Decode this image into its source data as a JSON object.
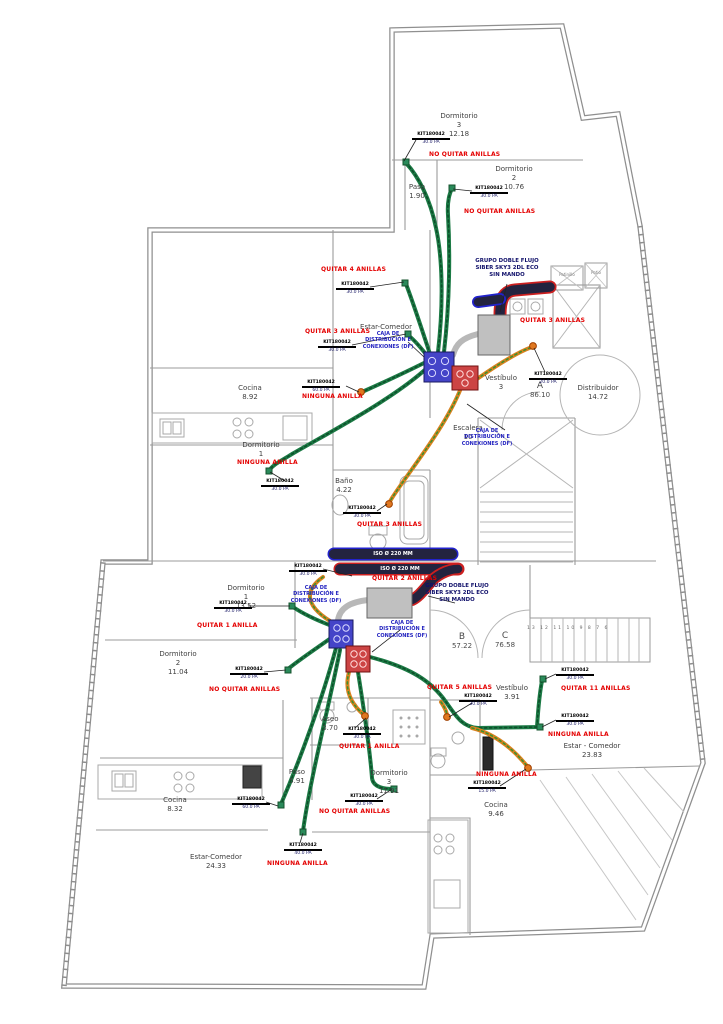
{
  "plan": {
    "apartments": [
      {
        "letter": "A",
        "area": "86.10"
      },
      {
        "letter": "B",
        "area": "57.22"
      },
      {
        "letter": "C",
        "area": "76.58"
      }
    ],
    "rooms": [
      {
        "name": "Dormitorio",
        "num": "3",
        "area": "12.18"
      },
      {
        "name": "Dormitorio",
        "num": "2",
        "area": "10.76"
      },
      {
        "name": "Paso",
        "num": "",
        "area": "1.90"
      },
      {
        "name": "Estar-Comedor",
        "num": "",
        "area": ""
      },
      {
        "name": "Cocina",
        "num": "",
        "area": "8.92"
      },
      {
        "name": "Dormitorio",
        "num": "1",
        "area": ""
      },
      {
        "name": "Baño",
        "num": "",
        "area": "4.22"
      },
      {
        "name": "Vestíbulo",
        "num": "3",
        "area": ""
      },
      {
        "name": "Distribuidor",
        "num": "",
        "area": "14.72"
      },
      {
        "name": "Escalera",
        "num": "10",
        "area": ""
      },
      {
        "name": "Dormitorio",
        "num": "1",
        "area": "13.52"
      },
      {
        "name": "Dormitorio",
        "num": "2",
        "area": "11.04"
      },
      {
        "name": "Cocina",
        "num": "",
        "area": "8.32"
      },
      {
        "name": "Estar-Comedor",
        "num": "",
        "area": "24.33"
      },
      {
        "name": "Dormitorio",
        "num": "3",
        "area": "11.91"
      },
      {
        "name": "Aseo",
        "num": "",
        "area": "3.70"
      },
      {
        "name": "Paso",
        "num": "",
        "area": "5.91"
      },
      {
        "name": "Vestíbulo",
        "num": "",
        "area": "3.91"
      },
      {
        "name": "Estar - Comedor",
        "num": "",
        "area": "23.83"
      },
      {
        "name": "Cocina",
        "num": "",
        "area": "9.46"
      }
    ],
    "ring_annotations": [
      "NO QUITAR ANILLAS",
      "NO QUITAR ANILLAS",
      "QUITAR 4 ANILLAS",
      "QUITAR 3 ANILLAS",
      "QUITAR 3 ANILLAS",
      "NINGUNA ANILLA",
      "NINGUNA ANILLA",
      "QUITAR 3 ANILLAS",
      "QUITAR 2 ANILLAS",
      "QUITAR 1 ANILLA",
      "NO QUITAR ANILLAS",
      "QUITAR 5 ANILLAS",
      "QUITAR 11 ANILLAS",
      "NINGUNA ANILLA",
      "QUITAR 1 ANILLA",
      "NO QUITAR ANILLAS",
      "NINGUNA ANILLA",
      "NINGUNA ANILLA"
    ],
    "unit_label": {
      "l1": "GRUPO DOBLE FLUJO",
      "l2": "SIBER SKY3 2DL ECO",
      "l3": "SIN MANDO"
    },
    "box_label": {
      "l1": "CAJA DE",
      "l2": "DISTRIBUCIÓN E",
      "l3": "CONEXIONES (DF)"
    },
    "duct_labels": [
      "ISO Ø 220 MM",
      "ISO Ø 220 MM"
    ],
    "tags": [
      {
        "ref": "KIT180042",
        "value": "30.0 PA"
      },
      {
        "ref": "KIT180042",
        "value": "30.0 PA"
      },
      {
        "ref": "KIT180042",
        "value": "30.0 PA"
      },
      {
        "ref": "KIT180042",
        "value": "30.0 PA"
      },
      {
        "ref": "KIT180042",
        "value": "60.0 PA"
      },
      {
        "ref": "KIT180042",
        "value": "30.0 PA"
      },
      {
        "ref": "KIT180042",
        "value": "30.0 PA"
      },
      {
        "ref": "KIT180042",
        "value": "20.0 PA"
      },
      {
        "ref": "KIT180042",
        "value": "30.0 PA"
      },
      {
        "ref": "KIT180042",
        "value": "30.0 PA"
      },
      {
        "ref": "KIT180042",
        "value": "20.0 PA"
      },
      {
        "ref": "KIT180042",
        "value": "30.0 PA"
      },
      {
        "ref": "KIT180042",
        "value": "60.0 PA"
      },
      {
        "ref": "KIT180042",
        "value": "30.0 PA"
      },
      {
        "ref": "KIT180042",
        "value": "40.0 PA"
      },
      {
        "ref": "KIT180042",
        "value": "30.0 PA"
      },
      {
        "ref": "KIT180042",
        "value": "30.0 PA"
      },
      {
        "ref": "KIT180042",
        "value": "30.0 PA"
      },
      {
        "ref": "KIT180042",
        "value": "15.0 PA"
      }
    ],
    "stair_numbers": "13 12 11 10 9 8 7 6",
    "shaft_labels": [
      "Patinillo",
      "Patio"
    ],
    "colors": {
      "annotation_red": "#e40000",
      "label_blue": "#2424c0",
      "unit_navy": "#10106a",
      "duct_green": "#1c7a45",
      "flex_orange": "#d9821f",
      "insulated_navy": "#23233f",
      "outline_red": "#cc2020",
      "outline_blue": "#2222cc",
      "box_blue": "#4444c8",
      "box_red": "#cc4444",
      "unit_grey": "#c0c0c0",
      "wall_grey": "#8f8f8f"
    }
  }
}
